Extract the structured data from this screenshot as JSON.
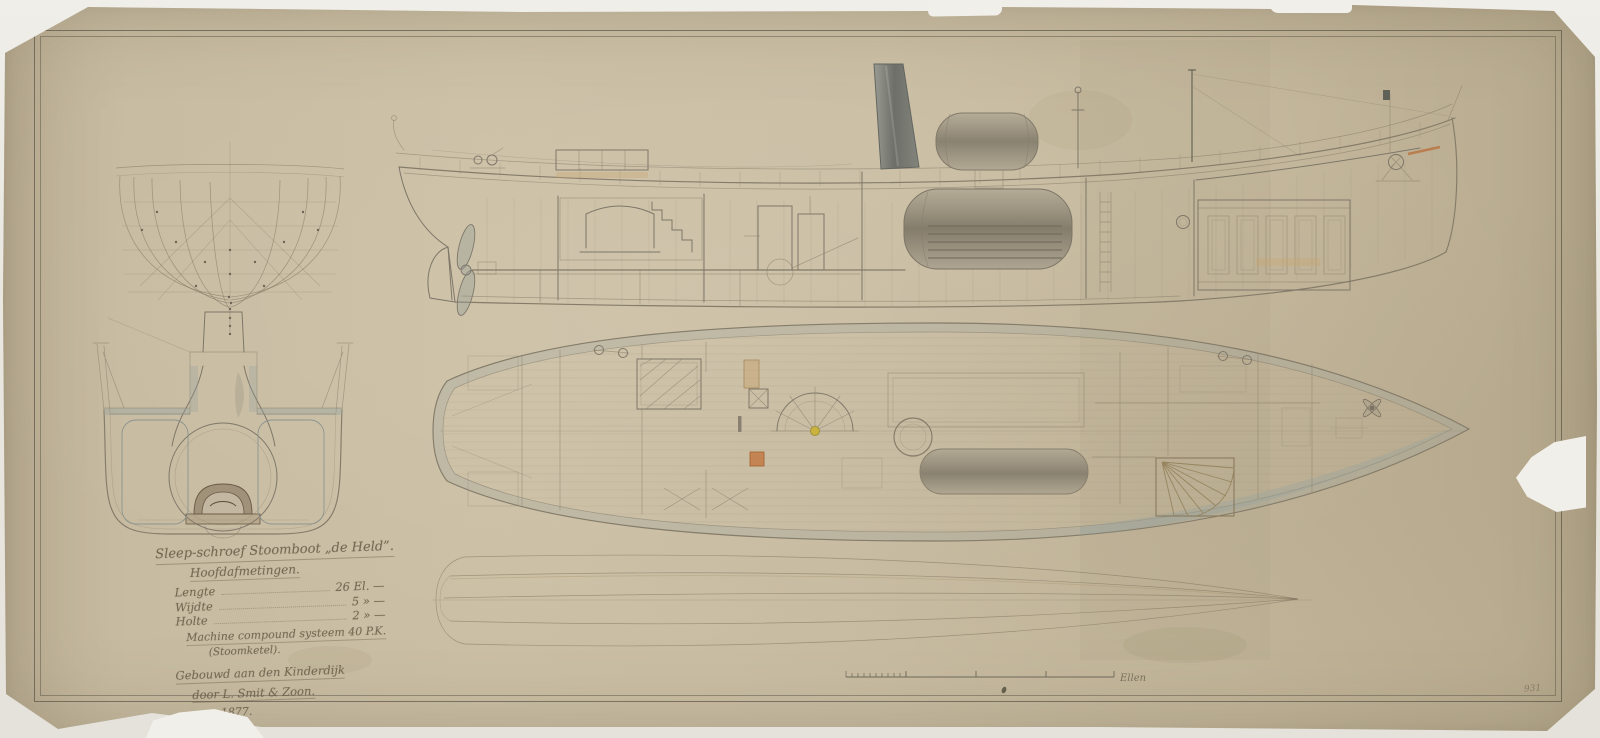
{
  "document": {
    "kind": "Scanned 19th-century Dutch shipyard construction drawing of a screw steam tug",
    "views_present": [
      "body plan",
      "boiler cross-section",
      "longitudinal section",
      "deck plan",
      "half-breadth waterlines plan"
    ]
  },
  "title_block": {
    "line1": "Sleep-schroef Stoomboot „de Held”.",
    "line2": "Hoofdafmetingen.",
    "dim_length_label": "Lengte",
    "dim_length_value": "26 El. —",
    "dim_width_label": "Wijdte",
    "dim_width_value": "5  »  —",
    "dim_depth_label": "Holte",
    "dim_depth_value": "2  »  —",
    "machine_line": "Machine compound systeem 40 P.K.",
    "machine_sub": "(Stoomketel).",
    "built_line1": "Gebouwd aan den Kinderdijk",
    "built_line2": "door L. Smit & Zoon.",
    "year": "1877."
  },
  "scale_bar": {
    "label": "Ellen"
  },
  "annotations": {
    "corner_number": "931"
  },
  "palette": {
    "backing": "#eceae4",
    "paper": "#c7bba1",
    "paper_edge": "#b2a68c",
    "frame_line": "#5c5646",
    "ink": "#7e7769",
    "pencil": "#8a8068",
    "wash_blue_gray": "#96a5a2",
    "wood_tan": "#c8a671",
    "accent_orange": "#c3763f",
    "funnel_dark": "#6d6f68",
    "wheel_hub_yellow": "#c9b23e"
  }
}
